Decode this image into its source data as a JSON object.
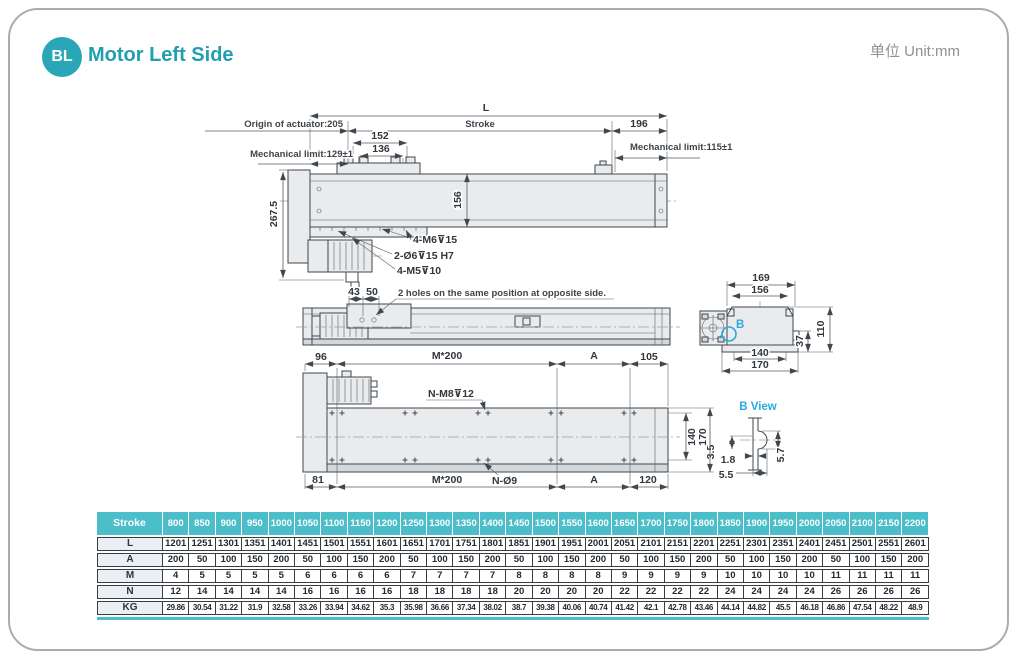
{
  "header": {
    "badge": "BL",
    "title": "Motor Left Side",
    "unit": "单位 Unit:mm"
  },
  "side_view": {
    "dim_L": "L",
    "origin": "Origin of actuator:205",
    "stroke_label": "Stroke",
    "dim_196": "196",
    "dim_152": "152",
    "dim_136": "136",
    "mech_left": "Mechanical limit:129±1",
    "mech_right": "Mechanical limit:115±1",
    "dim_267_5": "267.5",
    "dim_156": "156",
    "callout_m6": "4-M6⊽15",
    "callout_o6": "2-Ø6⊽15 H7",
    "callout_m5": "4-M5⊽10"
  },
  "plan_view": {
    "dim_43": "43",
    "dim_50": "50",
    "note": "2 holes on the same position at opposite side."
  },
  "end_view": {
    "dim_169": "169",
    "dim_156": "156",
    "dim_110": "110",
    "dim_37": "37",
    "dim_140": "140",
    "dim_170": "170",
    "b_label": "B"
  },
  "b_view": {
    "title": "B View",
    "dim_3_5": "3.5",
    "dim_1_8": "1.8",
    "dim_5_5": "5.5",
    "dim_5_7": "5.7"
  },
  "base_view": {
    "dim_96": "96",
    "dim_m200_top": "M*200",
    "dim_A_top": "A",
    "dim_105": "105",
    "callout_nm8": "N-M8⊽12",
    "dim_140": "140",
    "dim_170": "170",
    "dim_81": "81",
    "dim_m200_bottom": "M*200",
    "callout_no9": "N-Ø9",
    "dim_A_bottom": "A",
    "dim_120": "120"
  },
  "table": {
    "header_label": "Stroke",
    "strokes": [
      "800",
      "850",
      "900",
      "950",
      "1000",
      "1050",
      "1100",
      "1150",
      "1200",
      "1250",
      "1300",
      "1350",
      "1400",
      "1450",
      "1500",
      "1550",
      "1600",
      "1650",
      "1700",
      "1750",
      "1800",
      "1850",
      "1900",
      "1950",
      "2000",
      "2050",
      "2100",
      "2150",
      "2200"
    ],
    "rows": [
      {
        "label": "L",
        "values": [
          "1201",
          "1251",
          "1301",
          "1351",
          "1401",
          "1451",
          "1501",
          "1551",
          "1601",
          "1651",
          "1701",
          "1751",
          "1801",
          "1851",
          "1901",
          "1951",
          "2001",
          "2051",
          "2101",
          "2151",
          "2201",
          "2251",
          "2301",
          "2351",
          "2401",
          "2451",
          "2501",
          "2551",
          "2601"
        ]
      },
      {
        "label": "A",
        "values": [
          "200",
          "50",
          "100",
          "150",
          "200",
          "50",
          "100",
          "150",
          "200",
          "50",
          "100",
          "150",
          "200",
          "50",
          "100",
          "150",
          "200",
          "50",
          "100",
          "150",
          "200",
          "50",
          "100",
          "150",
          "200",
          "50",
          "100",
          "150",
          "200"
        ]
      },
      {
        "label": "M",
        "values": [
          "4",
          "5",
          "5",
          "5",
          "5",
          "6",
          "6",
          "6",
          "6",
          "7",
          "7",
          "7",
          "7",
          "8",
          "8",
          "8",
          "8",
          "9",
          "9",
          "9",
          "9",
          "10",
          "10",
          "10",
          "10",
          "11",
          "11",
          "11",
          "11"
        ]
      },
      {
        "label": "N",
        "values": [
          "12",
          "14",
          "14",
          "14",
          "14",
          "16",
          "16",
          "16",
          "16",
          "18",
          "18",
          "18",
          "18",
          "20",
          "20",
          "20",
          "20",
          "22",
          "22",
          "22",
          "22",
          "24",
          "24",
          "24",
          "24",
          "26",
          "26",
          "26",
          "26"
        ]
      },
      {
        "label": "KG",
        "values": [
          "29.86",
          "30.54",
          "31.22",
          "31.9",
          "32.58",
          "33.26",
          "33.94",
          "34.62",
          "35.3",
          "35.98",
          "36.66",
          "37.34",
          "38.02",
          "38.7",
          "39.38",
          "40.06",
          "40.74",
          "41.42",
          "42.1",
          "42.78",
          "43.46",
          "44.14",
          "44.82",
          "45.5",
          "46.18",
          "46.86",
          "47.54",
          "48.22",
          "48.9"
        ]
      }
    ]
  },
  "colors": {
    "accent": "#2aa7b7",
    "cyan": "#29a9df",
    "table_header": "#4bbec9"
  }
}
